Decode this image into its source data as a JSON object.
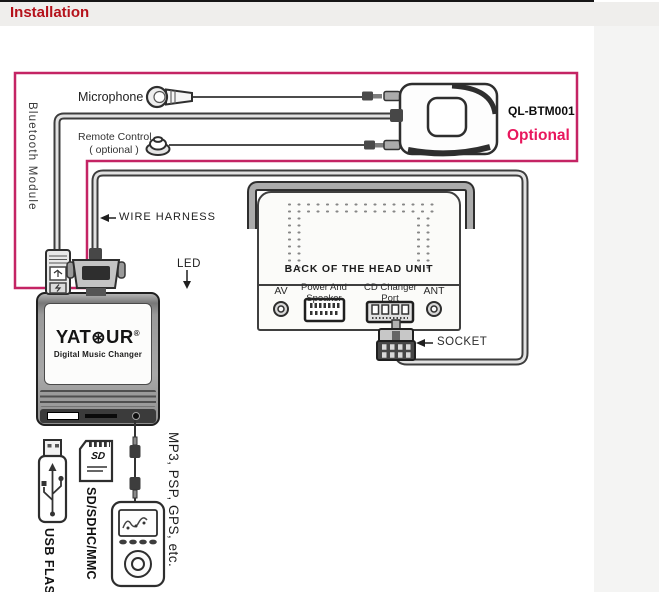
{
  "header": {
    "title": "Installation"
  },
  "colors": {
    "accent_pink": "#c42464",
    "title_red": "#b5121b",
    "optional_pink": "#e8175d",
    "line_dark": "#3d3d3d"
  },
  "bt_section": {
    "microphone_label": "Microphone",
    "remote_label": "Remote Control",
    "remote_sub": "( optional )",
    "module_vertical_label": "Bluetooth Module",
    "model": "QL-BTM001",
    "optional": "Optional"
  },
  "harness": {
    "wire_harness_label": "WIRE HARNESS",
    "led_label": "LED"
  },
  "yatour": {
    "brand_a": "YAT",
    "brand_o": "⊛",
    "brand_b": "UR",
    "reg": "®",
    "tagline": "Digital Music Changer"
  },
  "head_unit": {
    "caption": "BACK OF THE HEAD UNIT",
    "av": "AV",
    "power1": "Power And",
    "power2": "Speaker",
    "cd1": "CD Changer",
    "cd2": "Port",
    "ant": "ANT",
    "socket_label": "SOCKET"
  },
  "media": {
    "usb_label": "USB FLASH",
    "sd_label": "SD/SDHC/MMC",
    "players_label": "MP3, PSP, GPS, etc.",
    "sd_logo": "SD"
  }
}
